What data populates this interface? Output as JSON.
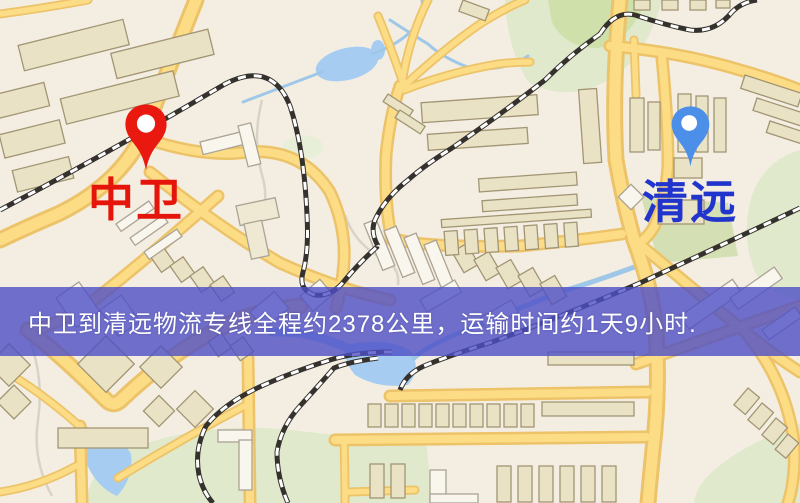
{
  "map": {
    "origin": {
      "name": "中卫",
      "pin_color": "#e9190f",
      "label_color": "#e5150c"
    },
    "destination": {
      "name": "清远",
      "pin_color": "#4c8fe9",
      "label_color": "#2134cc"
    }
  },
  "banner": {
    "text": "中卫到清远物流专线全程约2378公里，运输时间约1天9小时.",
    "distance_km": "2378",
    "duration": "1天9小时",
    "background_color": "#4d4fc5",
    "text_color": "#ffffff"
  },
  "map_colors": {
    "background": "#f4eee2",
    "road_fill": "#fcdd86",
    "road_casing": "#edc369",
    "park": "#e0e9cc",
    "water": "#a6cdf1",
    "railway": "#35322e",
    "building": "#eae2c5"
  }
}
